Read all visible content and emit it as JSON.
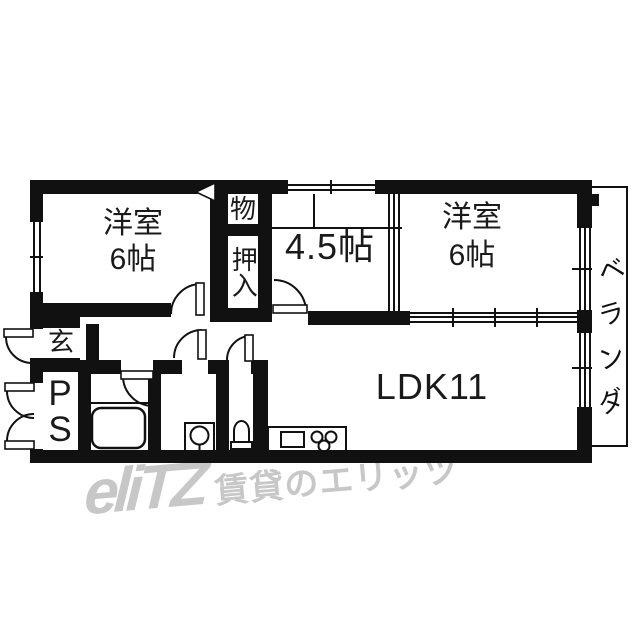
{
  "rooms": {
    "bedroom_left": {
      "name": "洋室",
      "size": "6帖"
    },
    "bedroom_right": {
      "name": "洋室",
      "size": "6帖"
    },
    "tatami": {
      "size": "4.5帖"
    },
    "ldk": {
      "label": "LDK11"
    },
    "storage": {
      "label": "物"
    },
    "closet": {
      "label": "押入"
    },
    "entrance": {
      "label": "玄"
    },
    "pipe_space": {
      "label": "PS"
    },
    "veranda": {
      "chars": [
        "ベ",
        "ラ",
        "ン",
        "ダ"
      ]
    }
  },
  "fixtures": [
    "bathtub",
    "washbasin",
    "toilet",
    "kitchen-sink",
    "gas-stove"
  ],
  "watermark": {
    "logo": "eliTZ",
    "text": "賃貸のエリッツ",
    "color": "#c7c7c7"
  },
  "colors": {
    "wall": "#111111",
    "background": "#ffffff"
  }
}
